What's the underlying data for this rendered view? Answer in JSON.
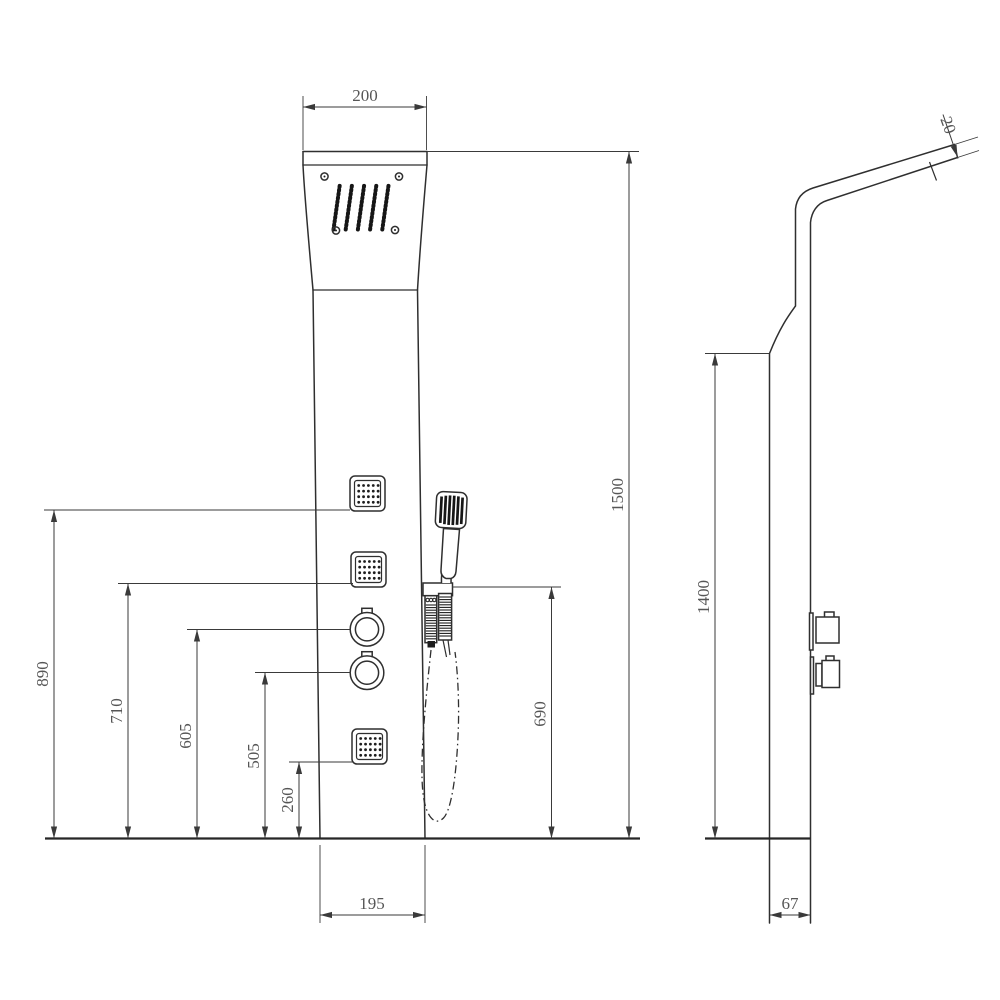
{
  "colors": {
    "line": "#2f2f2f",
    "dimension_line": "#3a3a3a",
    "text": "#565656",
    "background": "#ffffff"
  },
  "dims": {
    "head_width": "200",
    "overall_height": "1500",
    "handshower_height": "690",
    "jet_top_height": "890",
    "jet_mid_height": "710",
    "knob_top_height": "605",
    "knob_bottom_height": "505",
    "jet_bottom_height": "260",
    "panel_bottom_width": "195",
    "side_panel_height": "1400",
    "side_panel_depth": "67",
    "arm_thickness": "20"
  }
}
